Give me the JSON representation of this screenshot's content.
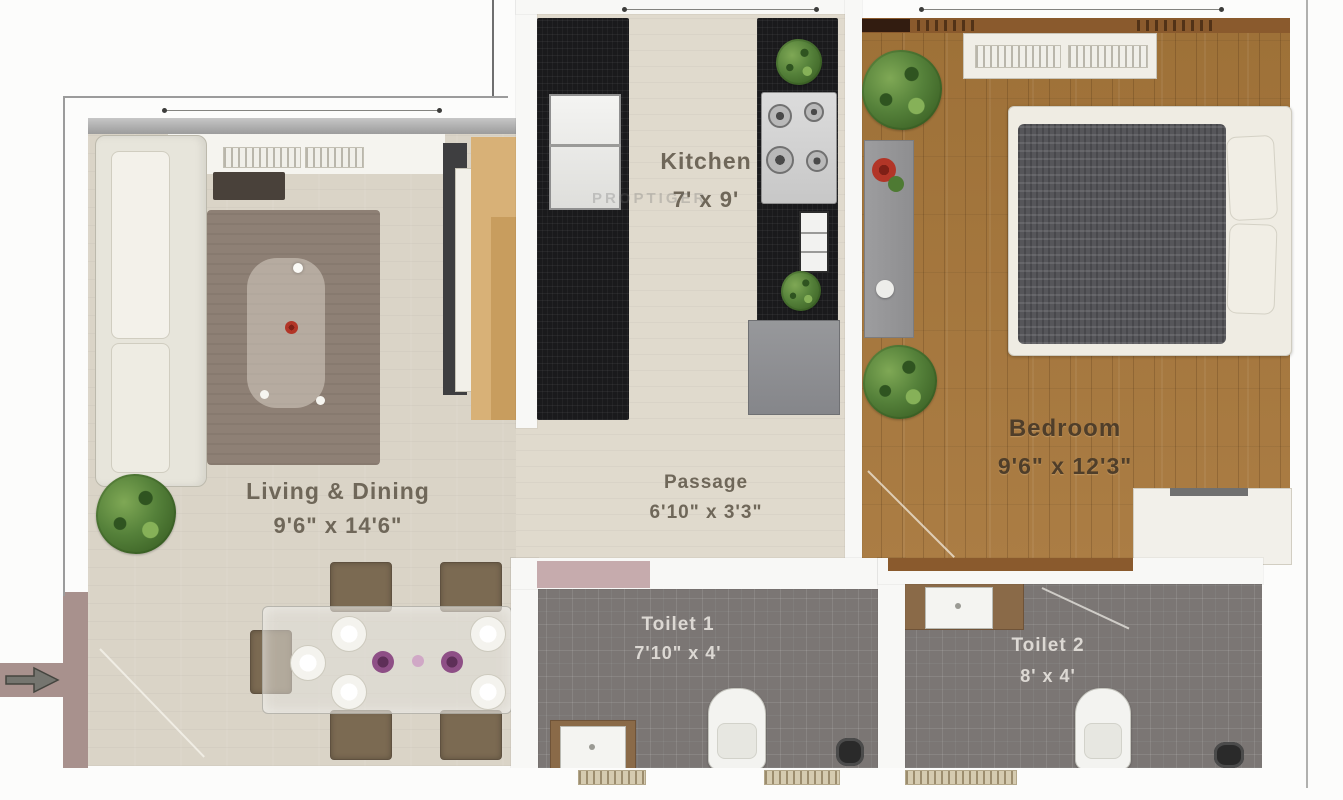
{
  "watermark": "PROPTIGER",
  "rooms": {
    "living": {
      "name": "Living & Dining",
      "dims": "9'6\" x 14'6\""
    },
    "kitchen": {
      "name": "Kitchen",
      "dims": "7' x 9'"
    },
    "passage": {
      "name": "Passage",
      "dims": "6'10\" x 3'3\""
    },
    "bedroom": {
      "name": "Bedroom",
      "dims": "9'6\" x 12'3\""
    },
    "toilet1": {
      "name": "Toilet 1",
      "dims": "7'10\" x 4'"
    },
    "toilet2": {
      "name": "Toilet 2",
      "dims": "8' x 4'"
    }
  },
  "palette": {
    "floor_beige": "#dad4c7",
    "kitchen_floor": "#e0dacd",
    "wood_floor": "#a5783f",
    "counter_black": "#1a1a1c",
    "tile_gray": "#7b7674",
    "wall_white": "#f8f8f6",
    "counter_wood": "#8a6a48",
    "wall_band_wood": "#8a5a2d",
    "entrance_mauve": "#a8918d",
    "shower_pink": "#c6abad",
    "plant_green": "#55813a",
    "rug_brown": "#8e8075",
    "sofa_cream": "#e7e5db",
    "bed_blanket": "#56565a",
    "accent_red": "#b23527",
    "bowl_purple": "#8e4f86",
    "label_dark": "#6f6759",
    "label_light": "#dbd8d2",
    "label_bedroom": "#4f3e2a"
  }
}
